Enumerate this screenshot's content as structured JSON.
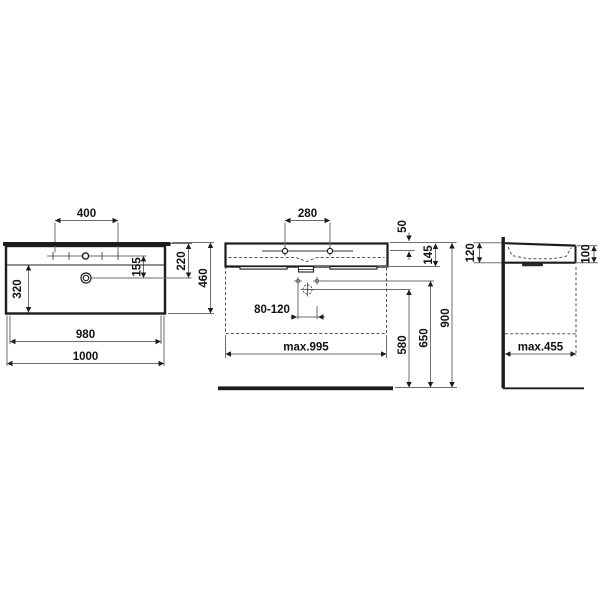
{
  "title": "washbasin-technical-drawing",
  "colors": {
    "background": "#ffffff",
    "object_line": "#1c1c1c",
    "dimension_line": "#6e6e6e",
    "text": "#111111"
  },
  "views": {
    "plan": {
      "hole_spacing_outer": "400",
      "hole_to_drain": "155",
      "front_to_drain": "220",
      "depth": "460",
      "bowl_depth": "320",
      "width_inner": "980",
      "width_outer": "1000"
    },
    "front": {
      "hole_spacing": "280",
      "rim_to_hole": "50",
      "body_height": "145",
      "drain_offset_range": "80-120",
      "max_cabinet_width": "max.995",
      "drain_height": "580",
      "supply_height": "650",
      "rim_height": "900"
    },
    "side": {
      "back_height": "120",
      "front_height": "100",
      "max_cabinet_depth": "max.455"
    }
  }
}
